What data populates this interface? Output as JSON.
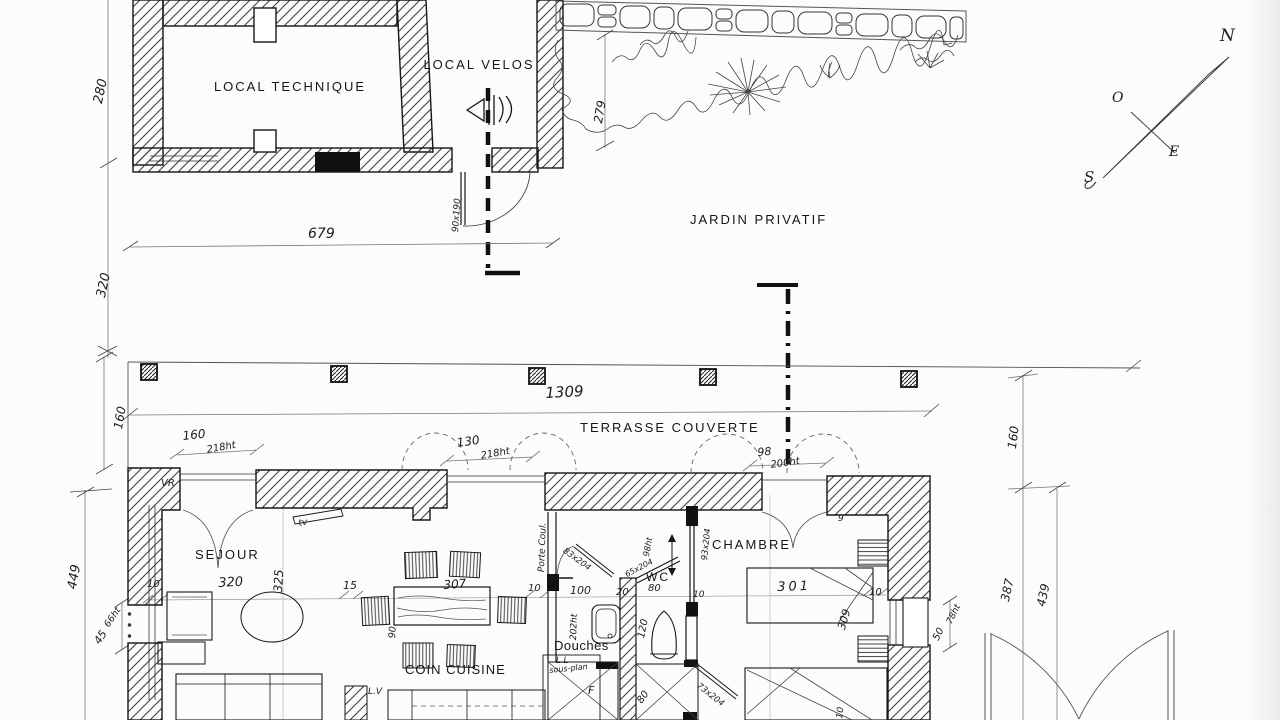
{
  "annex": {
    "local_technique": "LOCAL TECHNIQUE",
    "local_velos": "LOCAL VELOS"
  },
  "site": {
    "jardin": "JARDIN PRIVATIF",
    "terrasse": "TERRASSE COUVERTE"
  },
  "rooms": {
    "sejour": "SEJOUR",
    "chambre": "CHAMBRE",
    "coin_cuisine": "COIN CUISINE",
    "douches": "Douches",
    "wc": "WC"
  },
  "compass": {
    "n": "N",
    "o": "O",
    "e": "E",
    "s": "S"
  },
  "equipment": {
    "vr": "VR",
    "tv": "tv",
    "lv": "L.V",
    "ll_line1": "L.L",
    "ll_line2": "sous-plan",
    "porte_coul": "Porte Coul.",
    "f": "F"
  },
  "dims": {
    "annex_depth": "280",
    "gap": "320",
    "annex_width": "679",
    "garden_depth": "279",
    "annex_door": "90x190",
    "terrace_width": "1309",
    "terrace_depth_left": "160",
    "terrace_depth_right": "160",
    "win1": "160",
    "win1_ht": "218ht",
    "win2": "130",
    "win2_ht": "218ht",
    "entry": "98",
    "entry_ht": "200ht",
    "house_depth": "449",
    "left_win": "45",
    "left_win_ht": "66ht",
    "chain_10a": "10",
    "sejour_width": "320",
    "sejour_depth": "325",
    "chain_15": "15",
    "table_len": "307",
    "table_w": "90",
    "chain_10b": "10",
    "douches_w": "100",
    "wall_20": "20",
    "wc_w": "80",
    "chain_10c": "10",
    "chambre_w": "301",
    "chambre_d": "309",
    "chain_10d": "10",
    "right_387": "387",
    "right_439": "439",
    "right_win": "50",
    "right_win_ht": "78ht",
    "door_83": "83x204",
    "door_93": "93x204",
    "door_73": "73x204",
    "win_65": "65x204",
    "win_98ht": "98ht",
    "douches_ht": "202ht",
    "wc_120": "120",
    "shower_80": "80",
    "bed_9": "9",
    "bed_10": "10"
  }
}
